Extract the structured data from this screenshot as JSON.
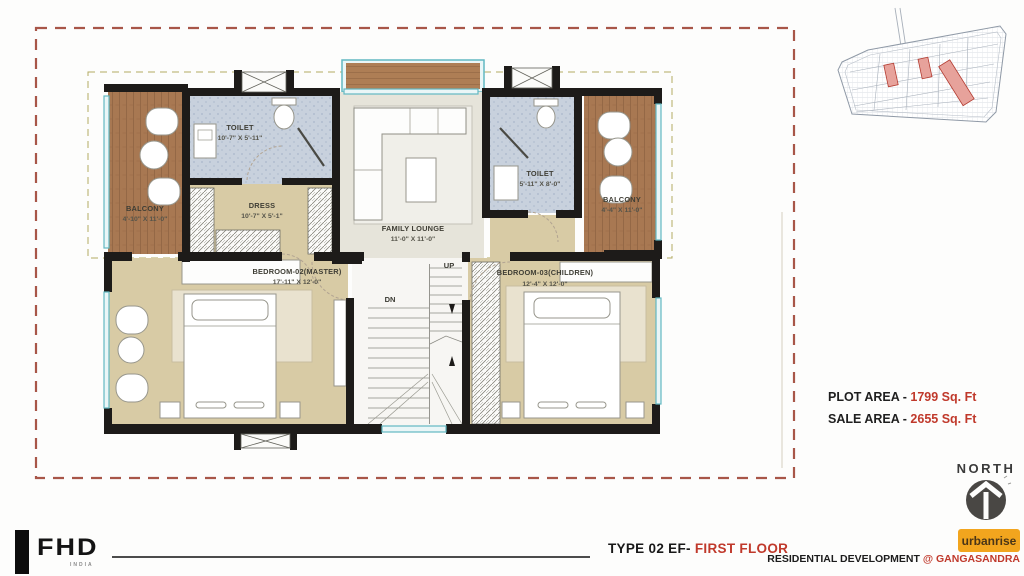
{
  "plan": {
    "rooms": {
      "balcony_left": {
        "name": "BALCONY",
        "dims": "4'-10\" X 11'-0\""
      },
      "toilet_left": {
        "name": "TOILET",
        "dims": "10'-7\" X 5'-11\""
      },
      "dress": {
        "name": "DRESS",
        "dims": "10'-7\" X 5'-1\""
      },
      "family_lounge": {
        "name": "FAMILY LOUNGE",
        "dims": "11'-0\" X 11'-0\""
      },
      "toilet_right": {
        "name": "TOILET",
        "dims": "5'-11\" X 8'-0\""
      },
      "balcony_right": {
        "name": "BALCONY",
        "dims": "4'-4\" X 11'-0\""
      },
      "bedroom_master": {
        "name": "BEDROOM-02(MASTER)",
        "dims": "17'-11\" X 12'-0\""
      },
      "bedroom_children": {
        "name": "BEDROOM-03(CHILDREN)",
        "dims": "12'-4\" X 12'-0\""
      }
    },
    "stairs": {
      "up": "UP",
      "dn": "DN"
    }
  },
  "areas": {
    "plot_label": "PLOT AREA - ",
    "plot_value": "1799 Sq. Ft",
    "sale_label": "SALE AREA - ",
    "sale_value": "2655 Sq. Ft"
  },
  "compass": {
    "label": "NORTH"
  },
  "footer": {
    "fhd_logo": "FHD",
    "fhd_sub": "INDIA",
    "plan_type": "TYPE 02 EF- ",
    "plan_floor": "FIRST FLOOR",
    "brand": "urbanrise",
    "dev_label": "RESIDENTIAL DEVELOPMENT ",
    "dev_location": "@ GANGASANDRA"
  },
  "colors": {
    "accent_red": "#c0392b",
    "border_dash_red": "#a85648",
    "wall_black": "#1d1b19",
    "wood_brown": "#a87852",
    "toilet_blue": "#c8d1dd",
    "bedroom_tan": "#d8cba5",
    "lounge_gray": "#e6e4da",
    "window_teal": "#62b8c2",
    "urbanrise_orange": "#f2a51e",
    "site_highlight": "#e7a29b"
  }
}
